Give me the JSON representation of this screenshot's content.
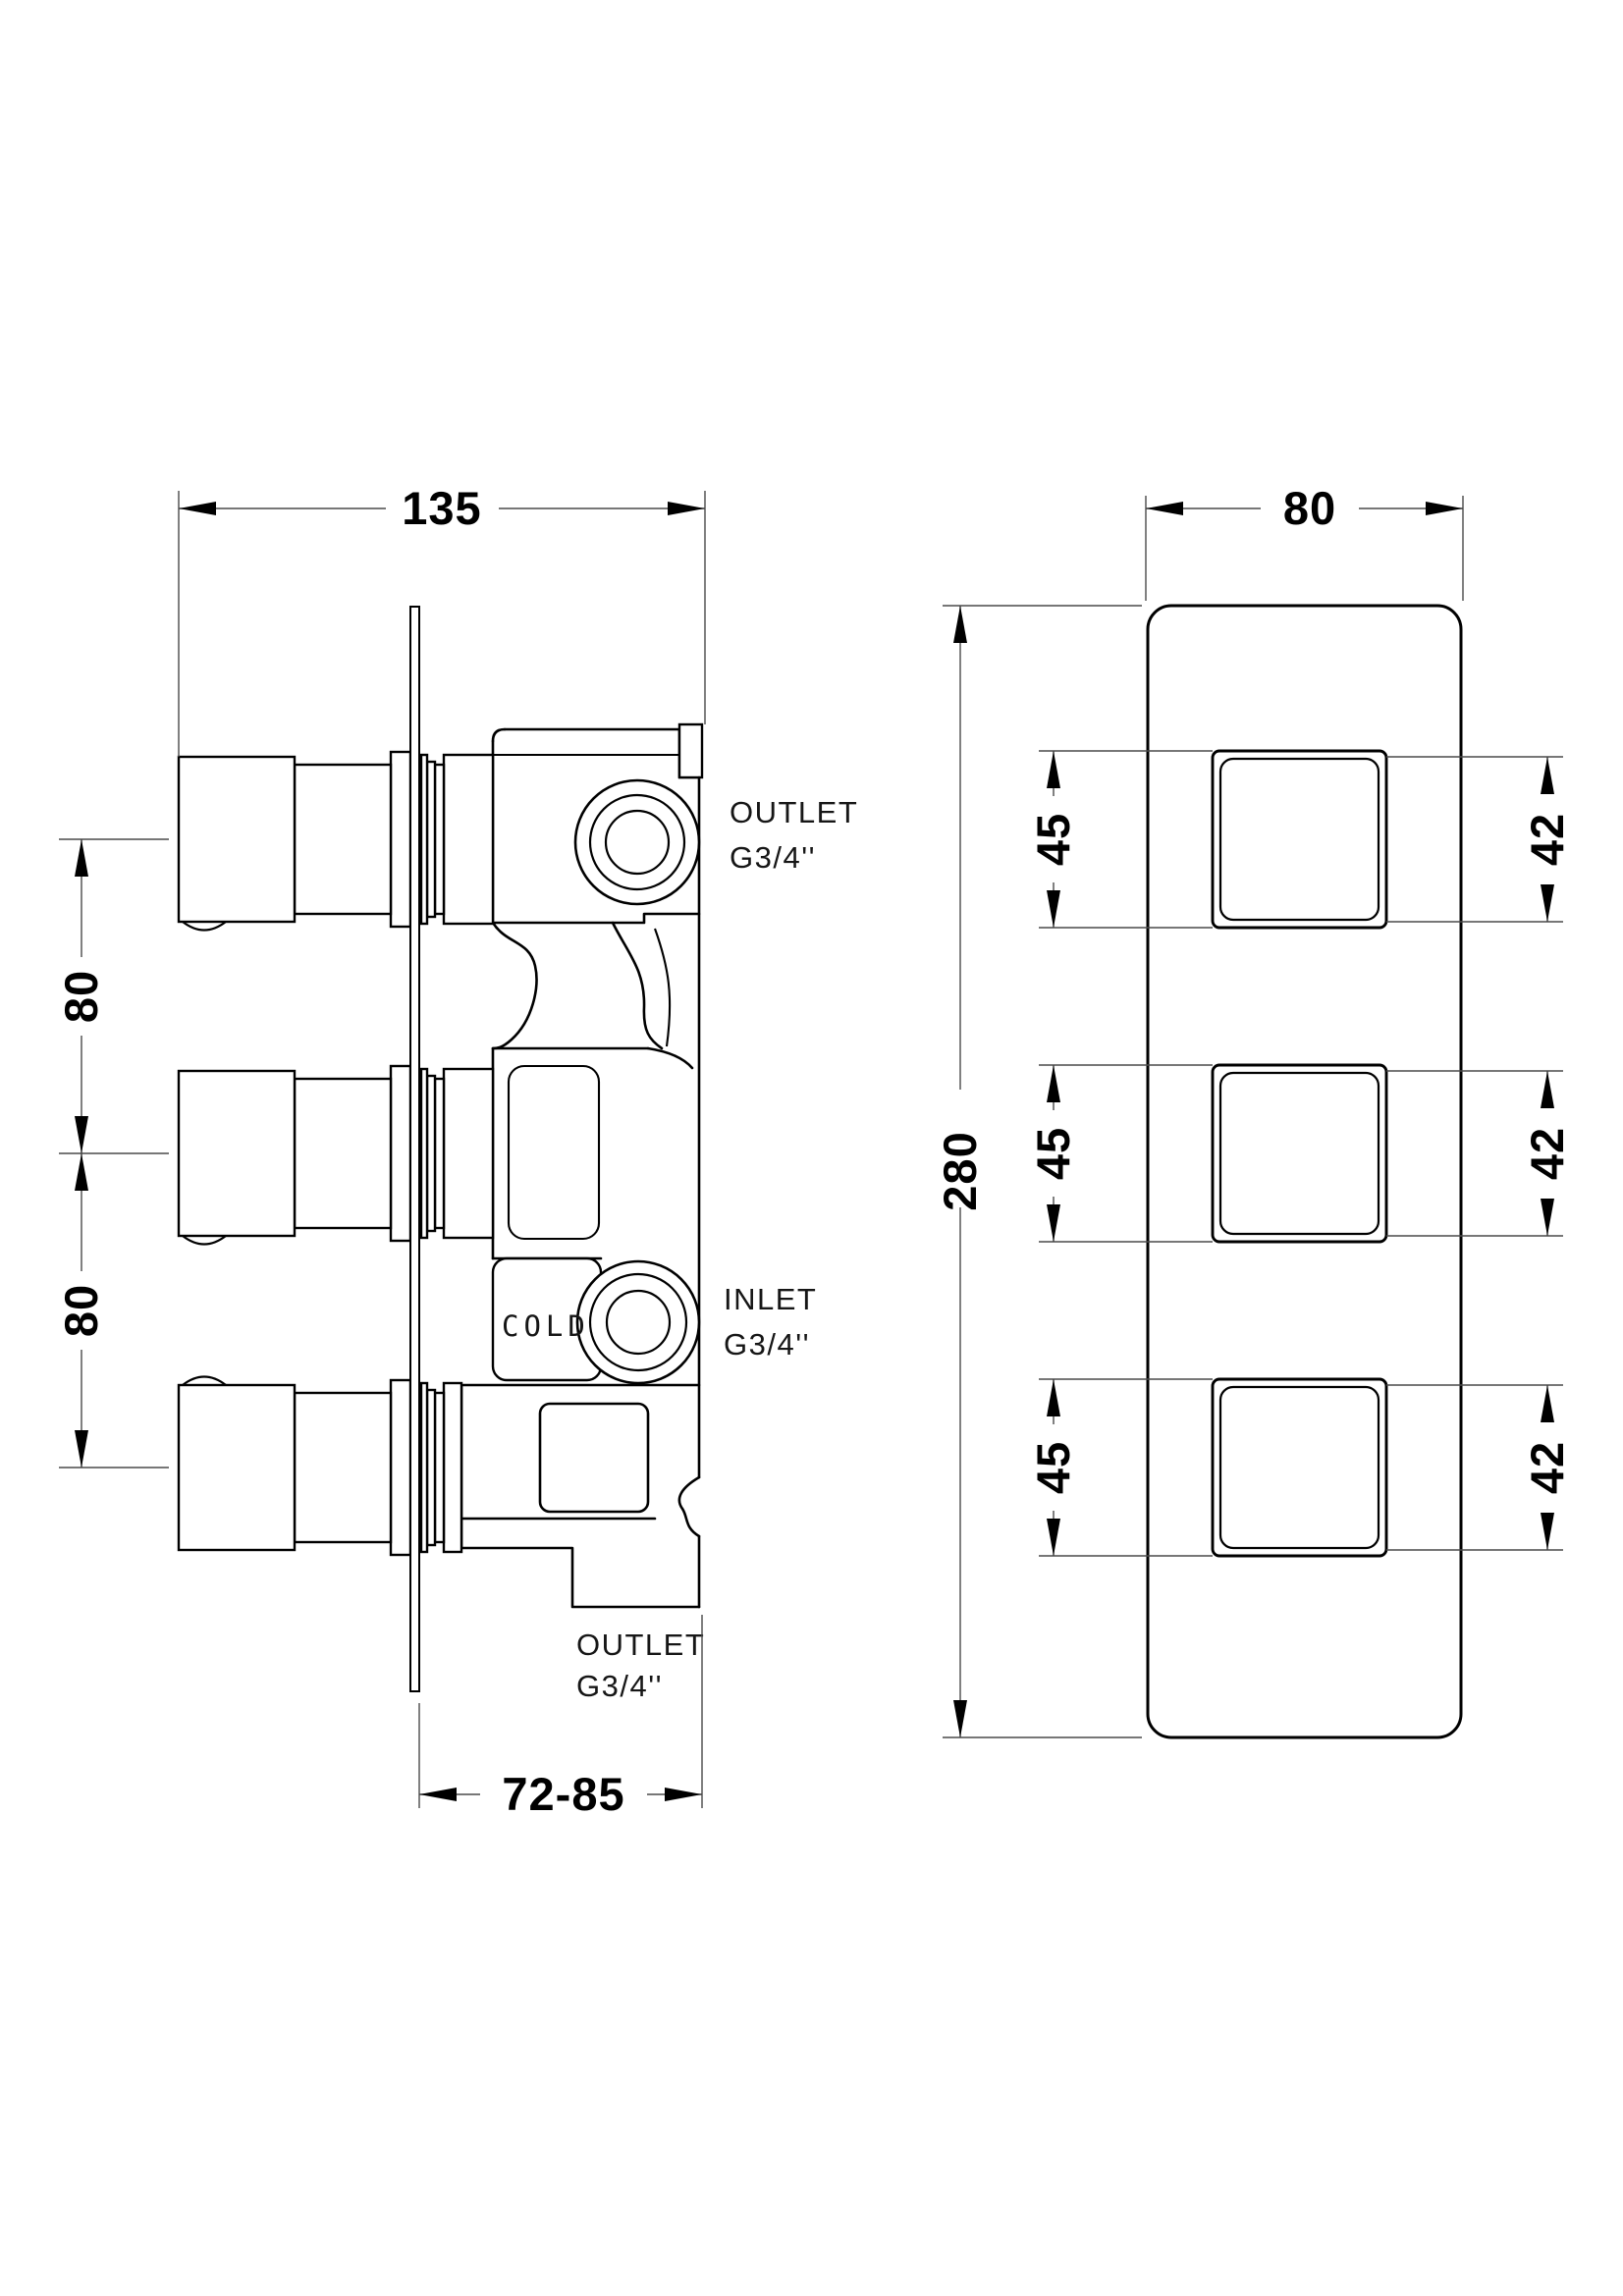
{
  "drawing": {
    "background": "#ffffff",
    "line_color": "#000000",
    "dim_line_color": "#4a4a4a"
  },
  "side_view": {
    "dim_overall_width": "135",
    "dim_handle_spacing_upper": "80",
    "dim_handle_spacing_lower": "80",
    "dim_installation_depth": "72-85",
    "label_outlet_top_line1": "OUTLET",
    "label_outlet_top_line2": "G3/4''",
    "label_inlet_line1": "INLET",
    "label_inlet_line2": "G3/4''",
    "label_outlet_bottom_line1": "OUTLET",
    "label_outlet_bottom_line2": "G3/4''",
    "marking_cold": "COLD"
  },
  "front_view": {
    "dim_plate_width": "80",
    "dim_plate_height": "280",
    "rows": [
      {
        "dim_plate_square": "45",
        "dim_handle_square": "42"
      },
      {
        "dim_plate_square": "45",
        "dim_handle_square": "42"
      },
      {
        "dim_plate_square": "45",
        "dim_handle_square": "42"
      }
    ]
  }
}
